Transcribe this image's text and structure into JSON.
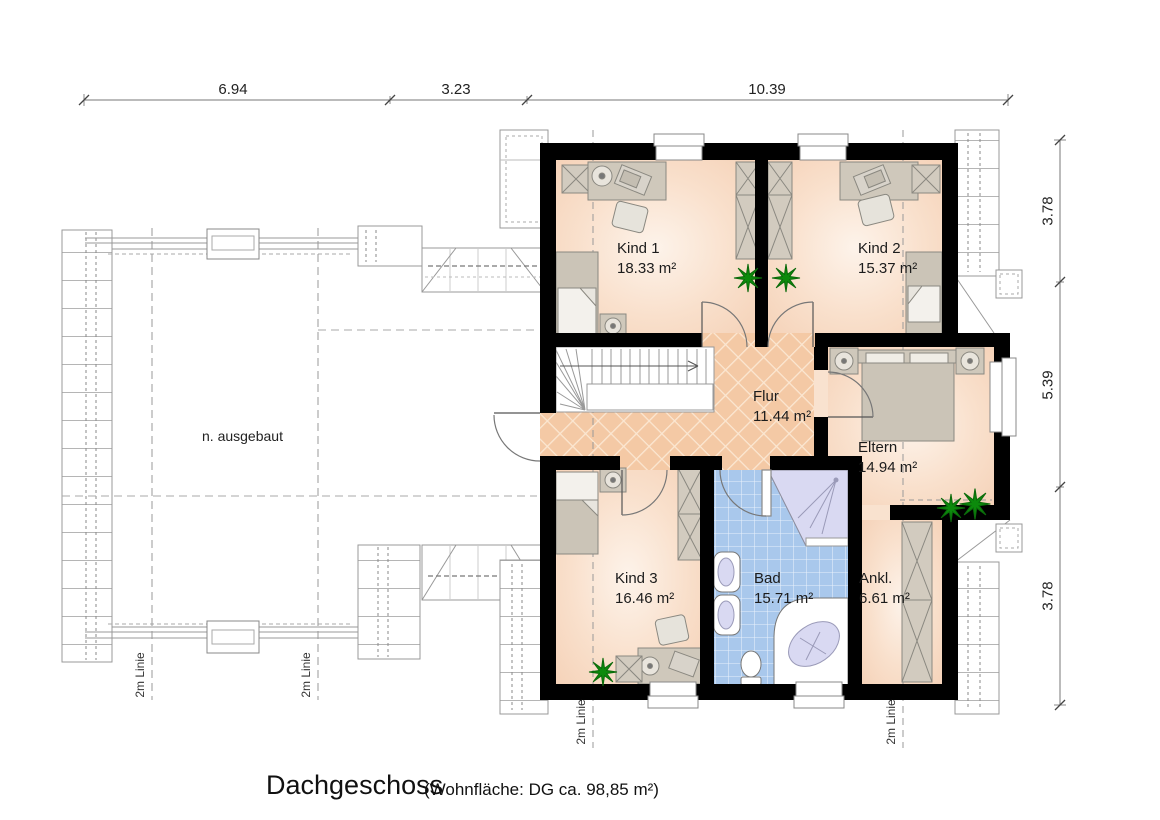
{
  "title": {
    "main": "Dachgeschoss",
    "sub": "(Wohnfläche: DG  ca. 98,85 m²)"
  },
  "dimensions": {
    "top": [
      "6.94",
      "3.23",
      "10.39"
    ],
    "right": [
      "3.78",
      "5.39",
      "3.78"
    ]
  },
  "rooms": {
    "kind1": {
      "name": "Kind 1",
      "area": "18.33 m²"
    },
    "kind2": {
      "name": "Kind 2",
      "area": "15.37 m²"
    },
    "kind3": {
      "name": "Kind 3",
      "area": "16.46 m²"
    },
    "bad": {
      "name": "Bad",
      "area": "15.71 m²"
    },
    "flur": {
      "name": "Flur",
      "area": "11.44 m²"
    },
    "eltern": {
      "name": "Eltern",
      "area": "14.94 m²"
    },
    "ankl": {
      "name": "Ankl.",
      "area": "6.61 m²"
    }
  },
  "labels": {
    "unfinished": "n. ausgebaut",
    "two_m": "2m Linie"
  },
  "colors": {
    "wall": "#000000",
    "room_floor": "#f8dcc6",
    "hall_floor": "#f4c9a5",
    "bath_tile": "#a9c8ec",
    "fixture": "#d9d9f2",
    "furniture": "#cfc8bb",
    "plant": "#0c8a0c"
  }
}
